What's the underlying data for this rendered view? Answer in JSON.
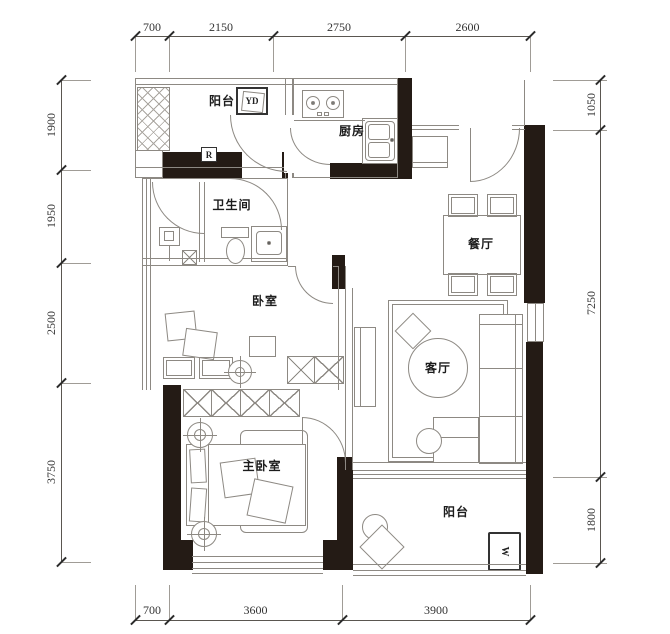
{
  "meta": {
    "type": "apartment-floor-plan"
  },
  "rooms": {
    "balcony_top": "阳台",
    "kitchen": "厨房",
    "bathroom": "卫生间",
    "dining": "餐厅",
    "bedroom": "卧室",
    "living": "客厅",
    "master_bedroom": "主卧室",
    "balcony_bottom": "阳台"
  },
  "markers": {
    "laundry": "YD",
    "washer": "W",
    "riser": "R"
  },
  "dims": {
    "top": [
      "700",
      "2150",
      "2750",
      "2600"
    ],
    "left": [
      "1900",
      "1950",
      "2500",
      "3750"
    ],
    "right": [
      "1050",
      "7250",
      "1800"
    ],
    "bottom": [
      "700",
      "3600",
      "3900"
    ]
  },
  "colors": {
    "wall": "#241b15",
    "line": "#8d8983",
    "text": "#1c1c1c",
    "dim_text": "#333333",
    "bg": "#ffffff"
  }
}
